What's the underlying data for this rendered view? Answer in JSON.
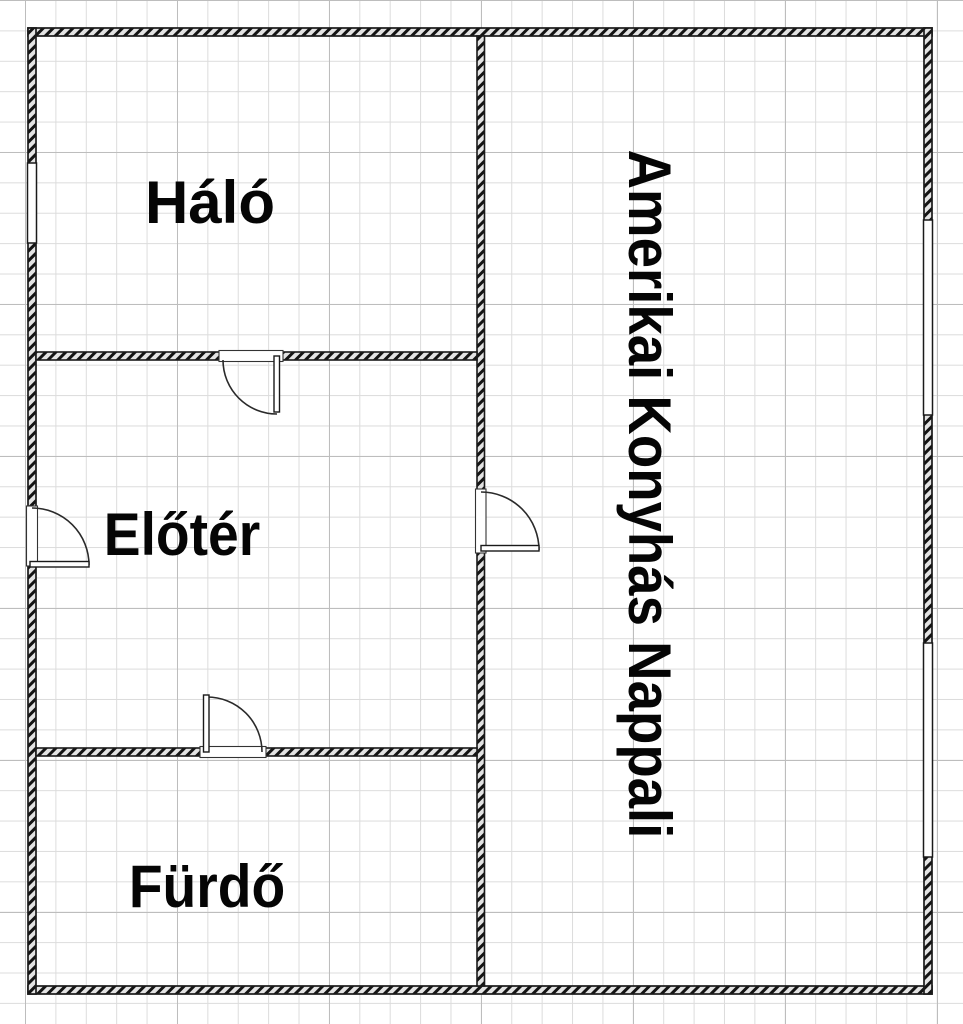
{
  "floorplan": {
    "rooms": [
      {
        "name": "halo",
        "label": "Háló"
      },
      {
        "name": "eloter",
        "label": "Előtér"
      },
      {
        "name": "furdo",
        "label": "Fürdő"
      },
      {
        "name": "nappali",
        "label": "Amerikai Konyhás Nappali"
      }
    ],
    "colors": {
      "wall_edge": "#1a1a1a",
      "wall_fill": "#e3e3e3",
      "grid_minor": "#dcdcdc",
      "grid_major": "#bdbdbd",
      "background": "#ffffff",
      "label_text": "#050505"
    }
  }
}
